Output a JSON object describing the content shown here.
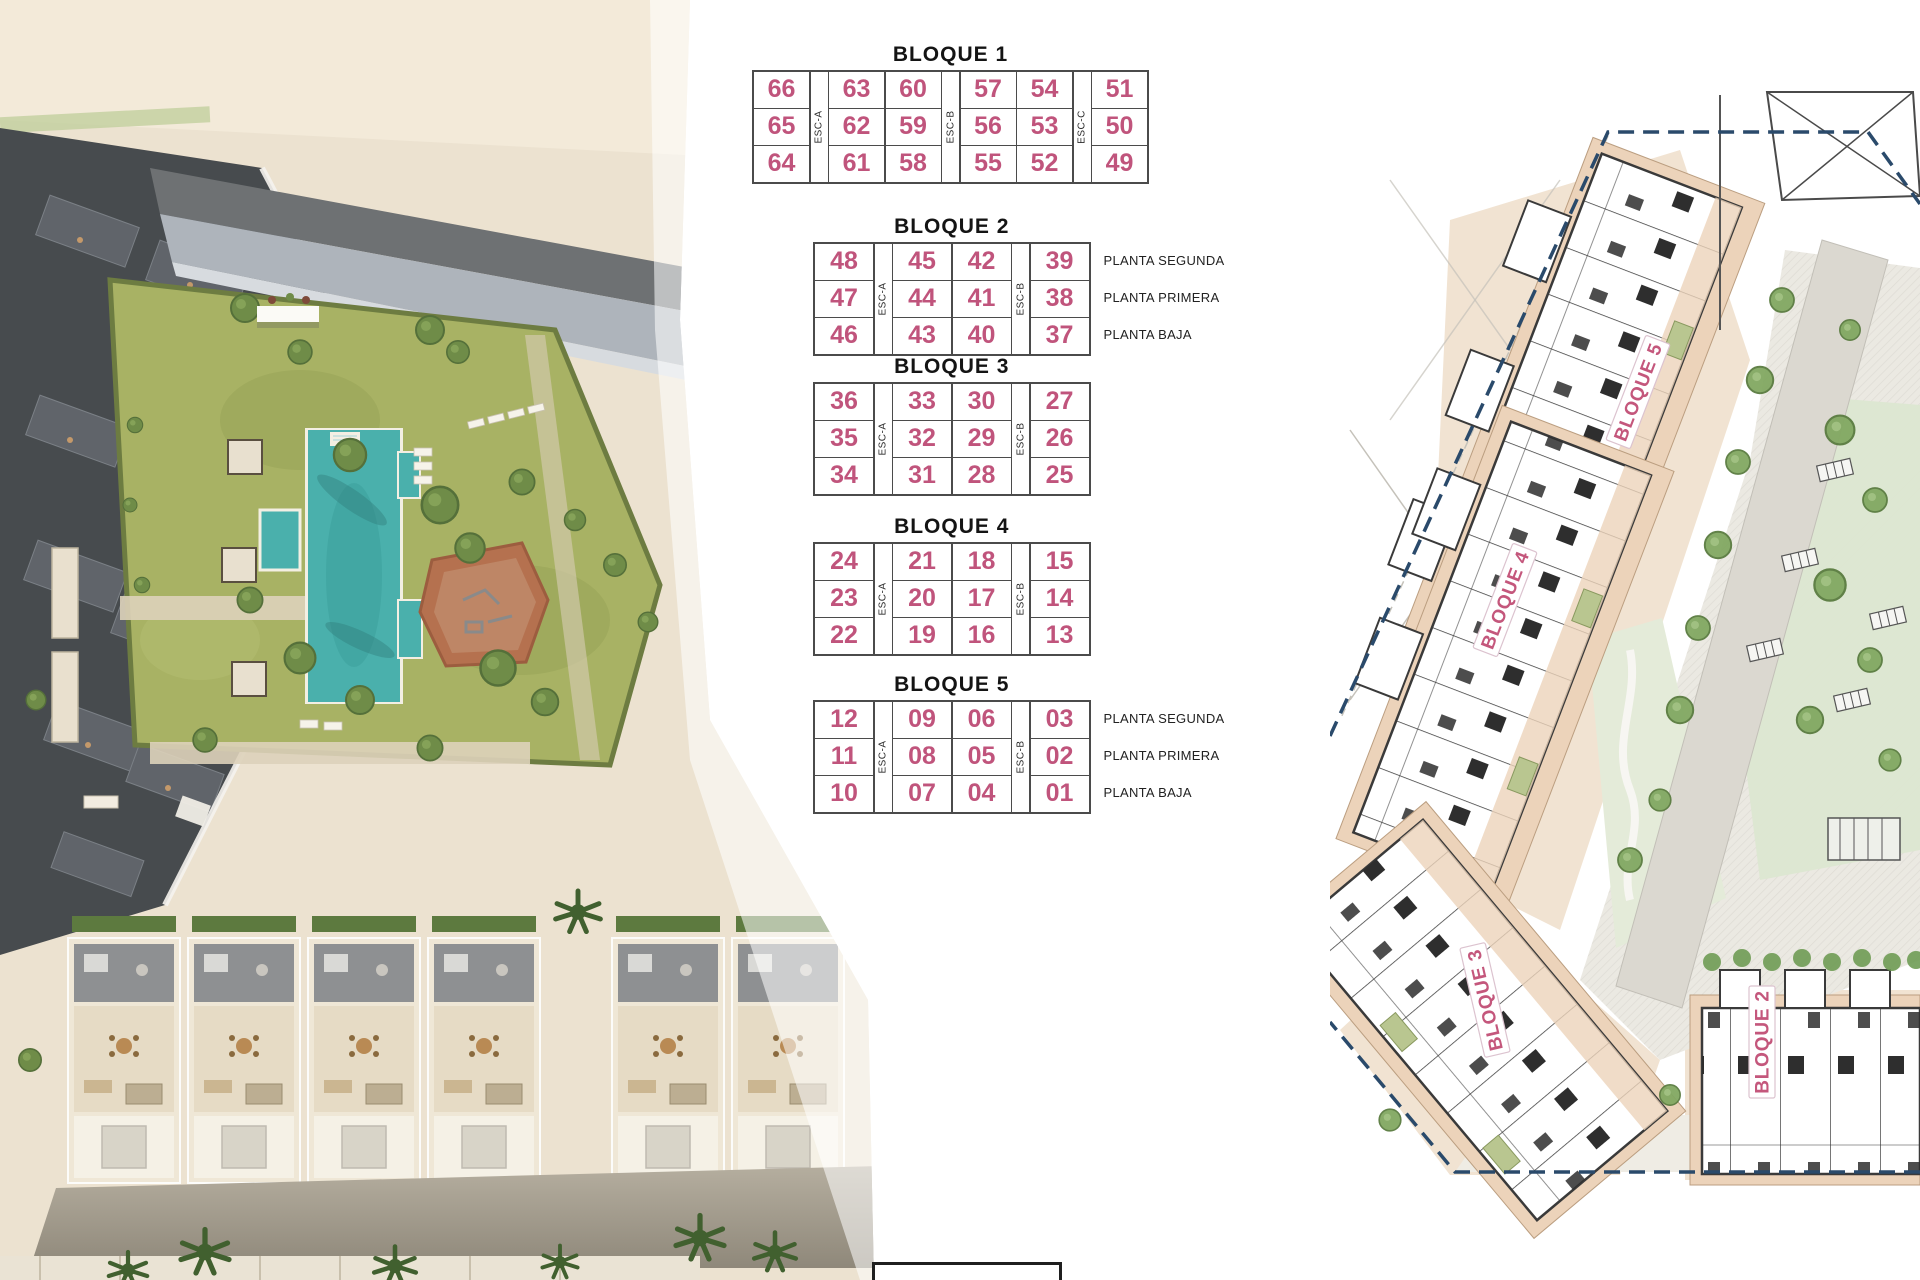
{
  "tables": [
    {
      "title": "BLOQUE 1",
      "esc": [
        "ESC-A",
        "ESC-B",
        "ESC-C"
      ],
      "esc_after": [
        0,
        2,
        4
      ],
      "rows": [
        [
          "66",
          "63",
          "60",
          "57",
          "54",
          "51"
        ],
        [
          "65",
          "62",
          "59",
          "56",
          "53",
          "50"
        ],
        [
          "64",
          "61",
          "58",
          "55",
          "52",
          "49"
        ]
      ],
      "planta": null
    },
    {
      "title": "BLOQUE 2",
      "esc": [
        "ESC-A",
        "ESC-B"
      ],
      "esc_after": [
        0,
        2
      ],
      "rows": [
        [
          "48",
          "45",
          "42",
          "39"
        ],
        [
          "47",
          "44",
          "41",
          "38"
        ],
        [
          "46",
          "43",
          "40",
          "37"
        ]
      ],
      "planta": [
        "PLANTA SEGUNDA",
        "PLANTA PRIMERA",
        "PLANTA BAJA"
      ]
    },
    {
      "title": "BLOQUE 3",
      "esc": [
        "ESC-A",
        "ESC-B"
      ],
      "esc_after": [
        0,
        2
      ],
      "rows": [
        [
          "36",
          "33",
          "30",
          "27"
        ],
        [
          "35",
          "32",
          "29",
          "26"
        ],
        [
          "34",
          "31",
          "28",
          "25"
        ]
      ],
      "planta": null
    },
    {
      "title": "BLOQUE 4",
      "esc": [
        "ESC-A",
        "ESC-B"
      ],
      "esc_after": [
        0,
        2
      ],
      "rows": [
        [
          "24",
          "21",
          "18",
          "15"
        ],
        [
          "23",
          "20",
          "17",
          "14"
        ],
        [
          "22",
          "19",
          "16",
          "13"
        ]
      ],
      "planta": null
    },
    {
      "title": "BLOQUE 5",
      "esc": [
        "ESC-A",
        "ESC-B"
      ],
      "esc_after": [
        0,
        2
      ],
      "rows": [
        [
          "12",
          "09",
          "06",
          "03"
        ],
        [
          "11",
          "08",
          "05",
          "02"
        ],
        [
          "10",
          "07",
          "04",
          "01"
        ]
      ],
      "planta": [
        "PLANTA SEGUNDA",
        "PLANTA PRIMERA",
        "PLANTA BAJA"
      ]
    }
  ],
  "site_plan": {
    "labels": [
      "BLOQUE 5",
      "BLOQUE 4",
      "BLOQUE 3",
      "BLOQUE 2"
    ]
  },
  "colors": {
    "unit_number_pink": "#c0547c",
    "plan_label_pink": "#c4577c",
    "table_border_gray": "#4b4b4b",
    "boundary_navy": "#2a4a6b",
    "pool_teal": "#4ab0ac",
    "lawn_green": "#a8b264",
    "building_tan": "#ecd3ba"
  }
}
